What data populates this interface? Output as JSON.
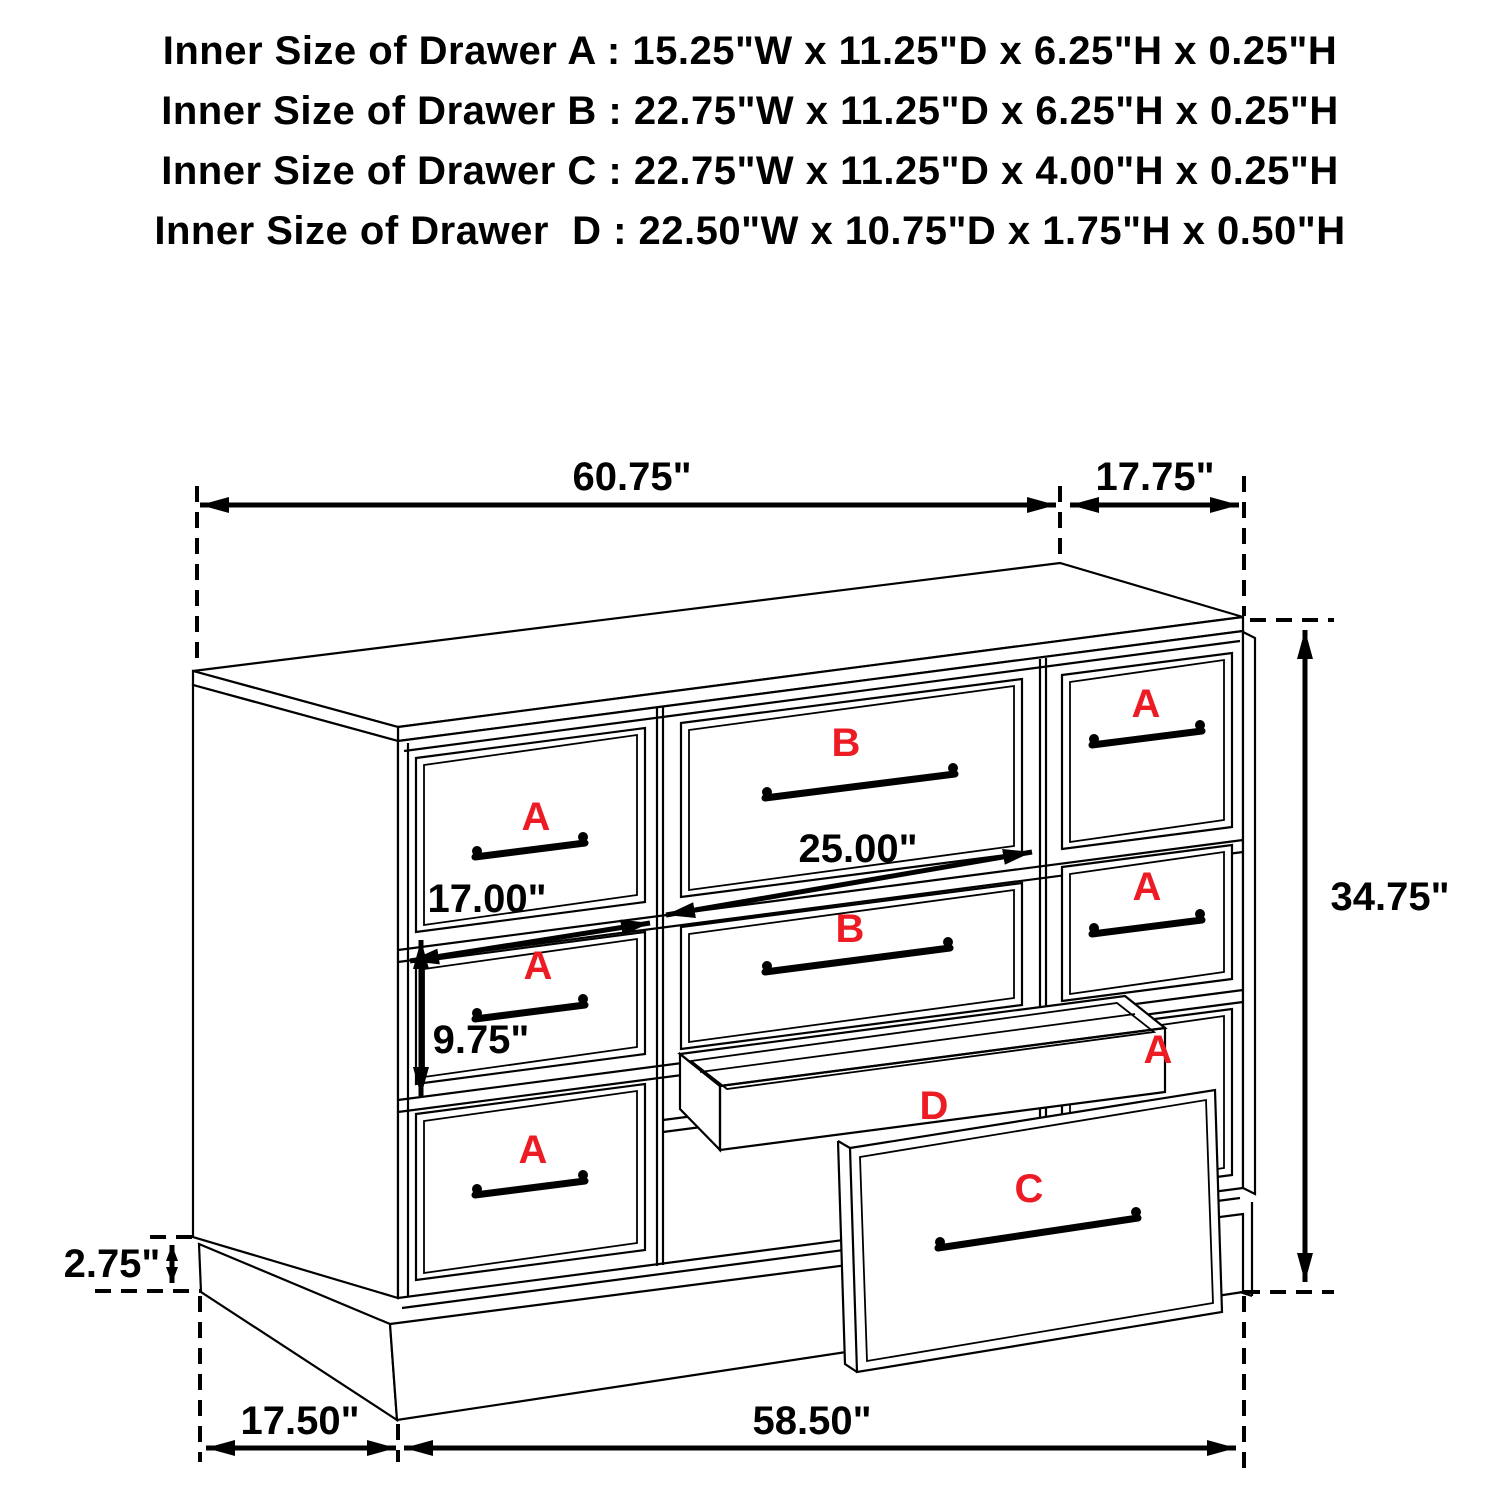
{
  "title_block": {
    "lines": [
      "Inner Size of Drawer A : 15.25\"W x 11.25\"D x 6.25\"H x 0.25\"H",
      "Inner Size of Drawer B : 22.75\"W x 11.25\"D x 6.25\"H x 0.25\"H",
      "Inner Size of Drawer C : 22.75\"W x 11.25\"D x 4.00\"H x 0.25\"H",
      "Inner Size of Drawer  D : 22.50\"W x 10.75\"D x 1.75\"H x 0.50\"H"
    ]
  },
  "diagram": {
    "dimensions": {
      "cabinet_width": "60.75\"",
      "cabinet_depth": "17.75\"",
      "cabinet_height": "34.75\"",
      "drawer_b_opening_width": "25.00\"",
      "drawer_a_opening_width": "17.00\"",
      "drawer_a_opening_height": "9.75\"",
      "base_height": "2.75\"",
      "base_depth": "17.50\"",
      "base_width": "58.50\""
    },
    "drawer_labels": {
      "left_column": [
        "A",
        "A",
        "A"
      ],
      "middle_column": [
        "B",
        "B"
      ],
      "right_column": [
        "A",
        "A",
        "A"
      ],
      "tray": "D",
      "bottom_drawer": "C"
    },
    "colors": {
      "label_red": "#ed1c24",
      "line": "#000000",
      "background": "#ffffff"
    }
  }
}
